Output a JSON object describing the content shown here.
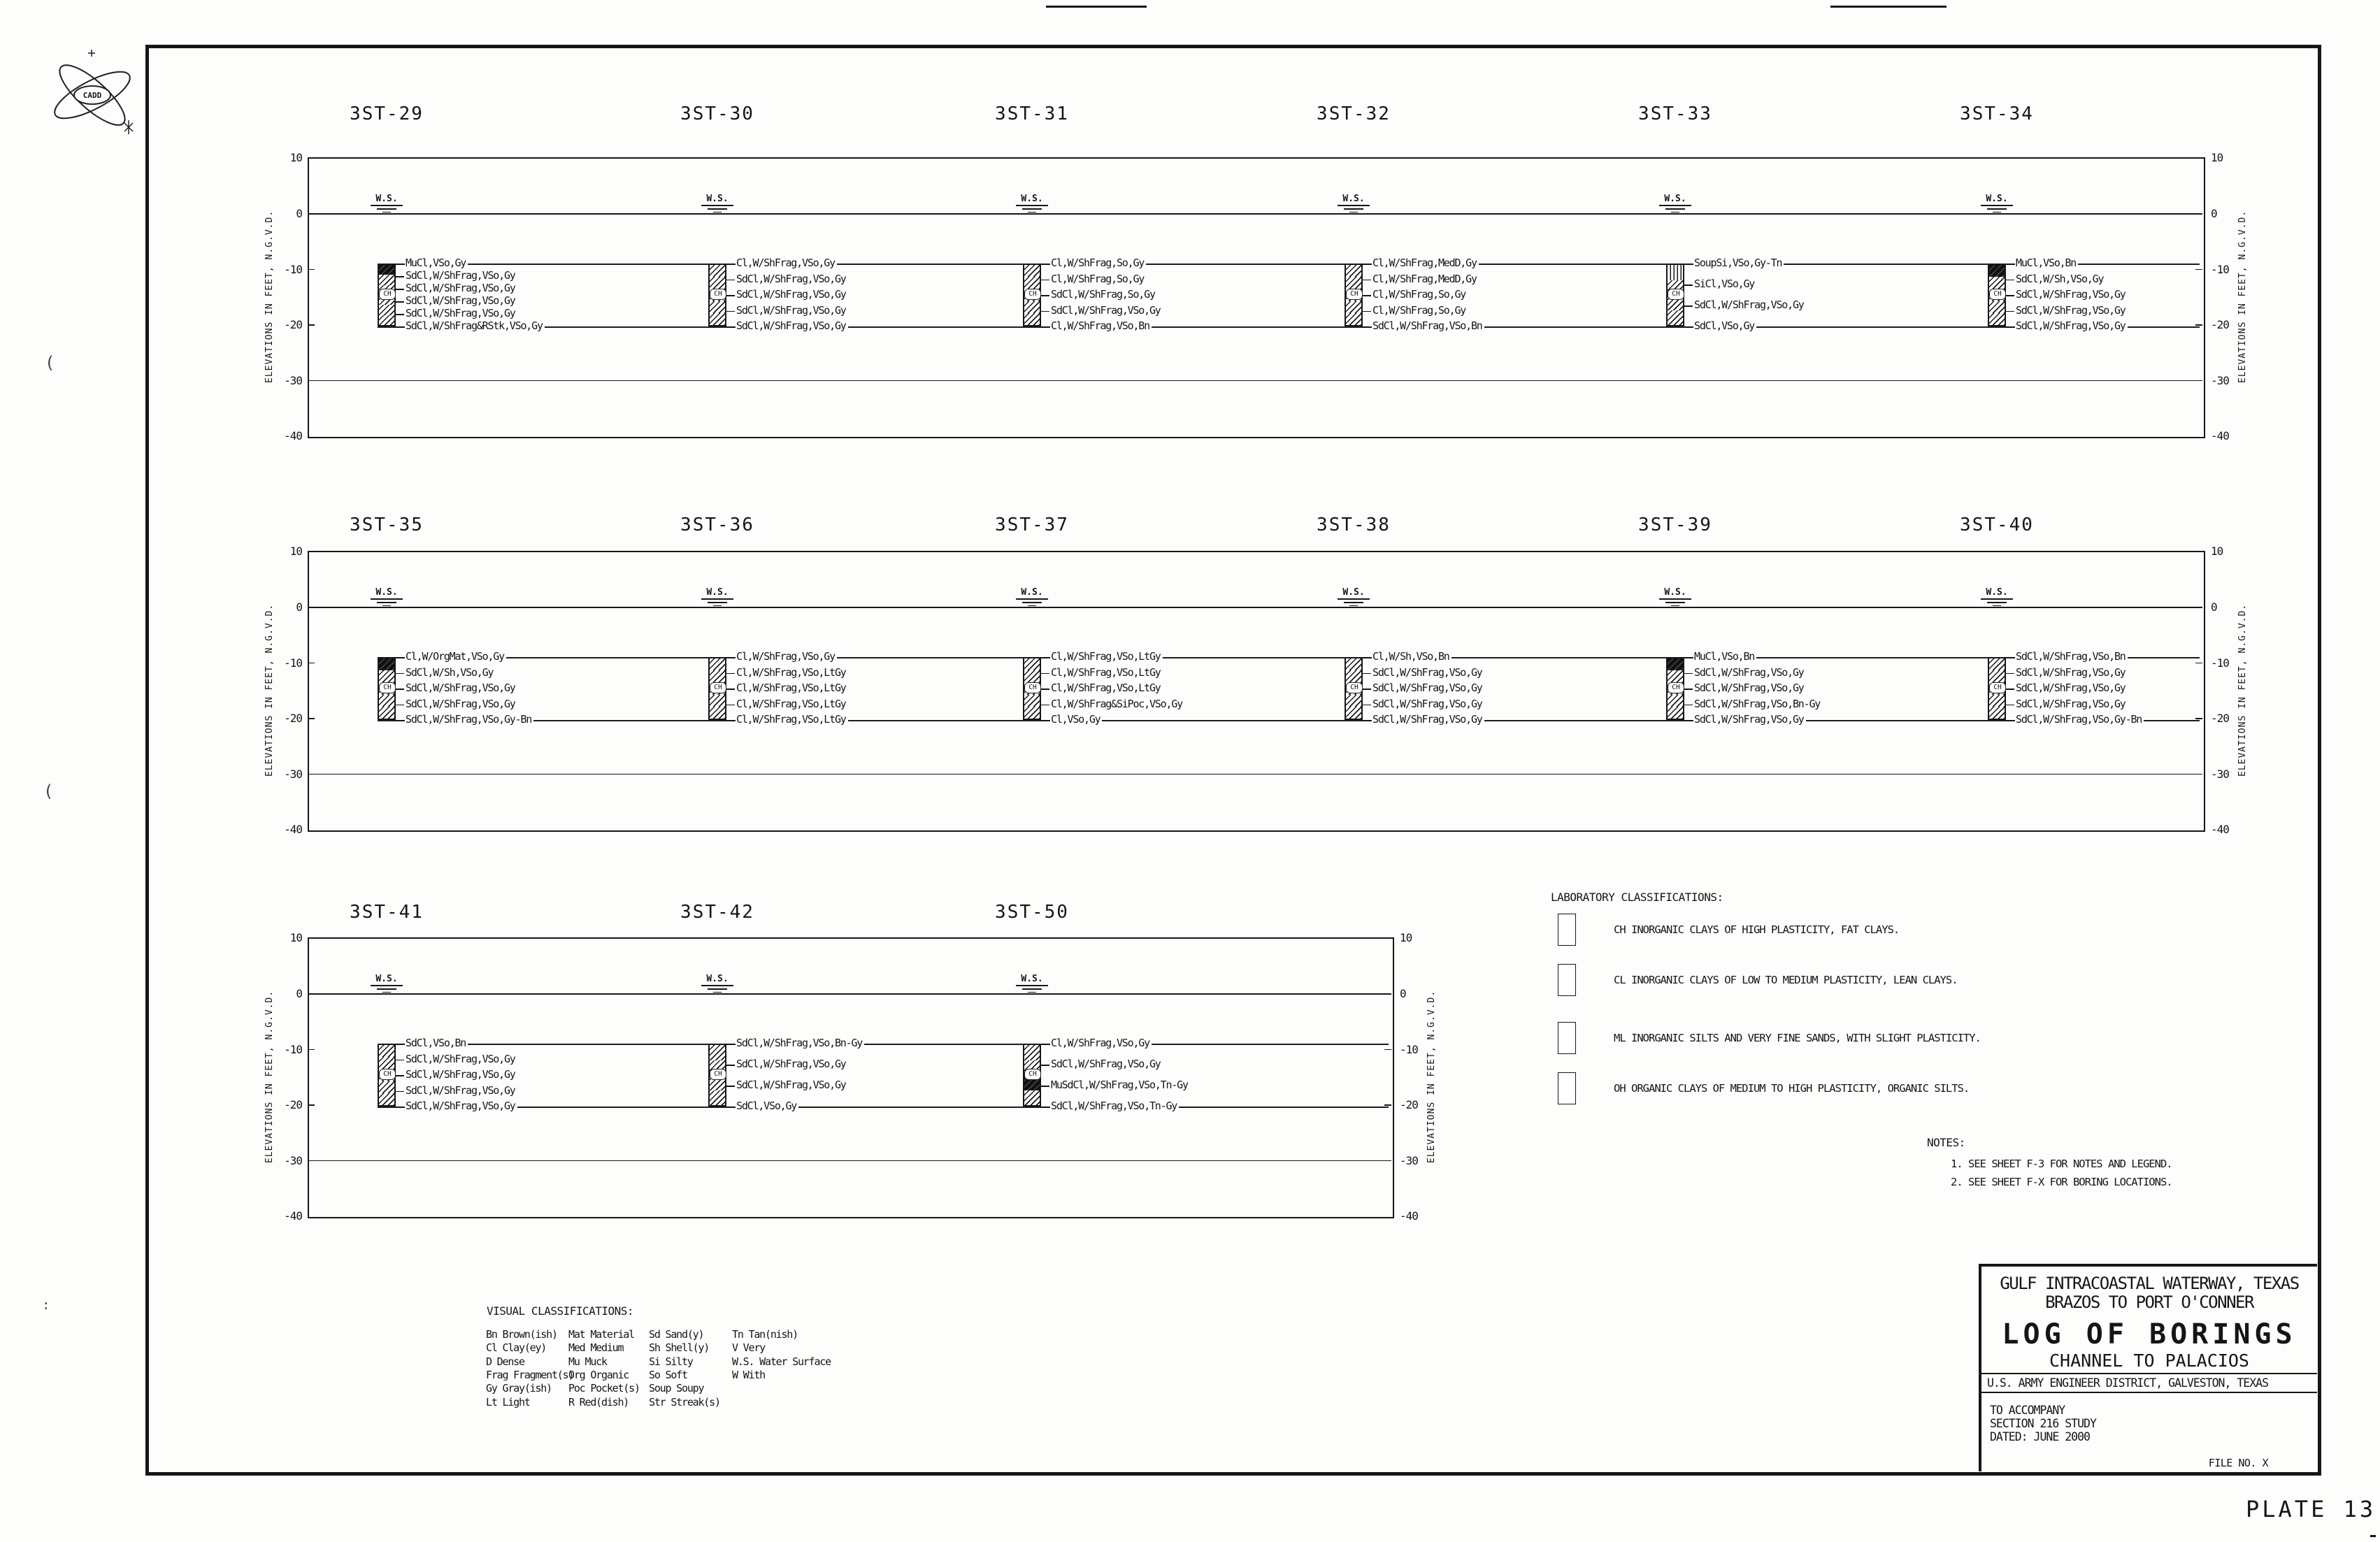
{
  "sheet": {
    "plate_label": "PLATE 13"
  },
  "cadd_logo": {
    "label": "CADD"
  },
  "axis": {
    "title": "ELEVATIONS IN FEET,  N.G.V.D.",
    "ticks": [
      "10",
      "0",
      "-10",
      "-20",
      "-30",
      "-40"
    ]
  },
  "water_surface_label": "W.S.",
  "column_class_label": "CH",
  "rows": [
    {
      "borings": [
        {
          "name": "3ST-29",
          "layers": [
            "MuCl,VSo,Gy",
            "SdCl,W/ShFrag,VSo,Gy",
            "SdCl,W/ShFrag,VSo,Gy",
            "SdCl,W/ShFrag,VSo,Gy",
            "SdCl,W/ShFrag,VSo,Gy",
            "SdCl,W/ShFrag&RStk,VSo,Gy"
          ]
        },
        {
          "name": "3ST-30",
          "layers": [
            "Cl,W/ShFrag,VSo,Gy",
            "SdCl,W/ShFrag,VSo,Gy",
            "SdCl,W/ShFrag,VSo,Gy",
            "SdCl,W/ShFrag,VSo,Gy",
            "SdCl,W/ShFrag,VSo,Gy"
          ]
        },
        {
          "name": "3ST-31",
          "layers": [
            "Cl,W/ShFrag,So,Gy",
            "Cl,W/ShFrag,So,Gy",
            "SdCl,W/ShFrag,So,Gy",
            "SdCl,W/ShFrag,VSo,Gy",
            "Cl,W/ShFrag,VSo,Bn"
          ]
        },
        {
          "name": "3ST-32",
          "layers": [
            "Cl,W/ShFrag,MedD,Gy",
            "Cl,W/ShFrag,MedD,Gy",
            "Cl,W/ShFrag,So,Gy",
            "Cl,W/ShFrag,So,Gy",
            "SdCl,W/ShFrag,VSo,Bn"
          ]
        },
        {
          "name": "3ST-33",
          "layers": [
            "SoupSi,VSo,Gy-Tn",
            "SiCl,VSo,Gy",
            "SdCl,W/ShFrag,VSo,Gy",
            "SdCl,VSo,Gy"
          ]
        },
        {
          "name": "3ST-34",
          "layers": [
            "MuCl,VSo,Bn",
            "SdCl,W/Sh,VSo,Gy",
            "SdCl,W/ShFrag,VSo,Gy",
            "SdCl,W/ShFrag,VSo,Gy",
            "SdCl,W/ShFrag,VSo,Gy"
          ]
        }
      ]
    },
    {
      "borings": [
        {
          "name": "3ST-35",
          "layers": [
            "Cl,W/OrgMat,VSo,Gy",
            "SdCl,W/Sh,VSo,Gy",
            "SdCl,W/ShFrag,VSo,Gy",
            "SdCl,W/ShFrag,VSo,Gy",
            "SdCl,W/ShFrag,VSo,Gy-Bn"
          ]
        },
        {
          "name": "3ST-36",
          "layers": [
            "Cl,W/ShFrag,VSo,Gy",
            "Cl,W/ShFrag,VSo,LtGy",
            "Cl,W/ShFrag,VSo,LtGy",
            "Cl,W/ShFrag,VSo,LtGy",
            "Cl,W/ShFrag,VSo,LtGy"
          ]
        },
        {
          "name": "3ST-37",
          "layers": [
            "Cl,W/ShFrag,VSo,LtGy",
            "Cl,W/ShFrag,VSo,LtGy",
            "Cl,W/ShFrag,VSo,LtGy",
            "Cl,W/ShFrag&SiPoc,VSo,Gy",
            "Cl,VSo,Gy"
          ]
        },
        {
          "name": "3ST-38",
          "layers": [
            "Cl,W/Sh,VSo,Bn",
            "SdCl,W/ShFrag,VSo,Gy",
            "SdCl,W/ShFrag,VSo,Gy",
            "SdCl,W/ShFrag,VSo,Gy",
            "SdCl,W/ShFrag,VSo,Gy"
          ]
        },
        {
          "name": "3ST-39",
          "layers": [
            "MuCl,VSo,Bn",
            "SdCl,W/ShFrag,VSo,Gy",
            "SdCl,W/ShFrag,VSo,Gy",
            "SdCl,W/ShFrag,VSo,Bn-Gy",
            "SdCl,W/ShFrag,VSo,Gy"
          ]
        },
        {
          "name": "3ST-40",
          "layers": [
            "SdCl,W/ShFrag,VSo,Bn",
            "SdCl,W/ShFrag,VSo,Gy",
            "SdCl,W/ShFrag,VSo,Gy",
            "SdCl,W/ShFrag,VSo,Gy",
            "SdCl,W/ShFrag,VSo,Gy-Bn"
          ]
        }
      ]
    },
    {
      "borings": [
        {
          "name": "3ST-41",
          "layers": [
            "SdCl,VSo,Bn",
            "SdCl,W/ShFrag,VSo,Gy",
            "SdCl,W/ShFrag,VSo,Gy",
            "SdCl,W/ShFrag,VSo,Gy",
            "SdCl,W/ShFrag,VSo,Gy"
          ]
        },
        {
          "name": "3ST-42",
          "layers": [
            "SdCl,W/ShFrag,VSo,Bn-Gy",
            "SdCl,W/ShFrag,VSo,Gy",
            "SdCl,W/ShFrag,VSo,Gy",
            "SdCl,VSo,Gy"
          ]
        },
        {
          "name": "3ST-50",
          "layers": [
            "Cl,W/ShFrag,VSo,Gy",
            "SdCl,W/ShFrag,VSo,Gy",
            "MuSdCl,W/ShFrag,VSo,Tn-Gy",
            "SdCl,W/ShFrag,VSo,Tn-Gy"
          ]
        }
      ]
    }
  ],
  "lab_classifications": {
    "title": "LABORATORY CLASSIFICATIONS:",
    "items": [
      {
        "pattern": "ch",
        "text": "CH INORGANIC CLAYS OF HIGH PLASTICITY, FAT CLAYS."
      },
      {
        "pattern": "cl",
        "text": "CL INORGANIC CLAYS OF LOW TO MEDIUM PLASTICITY, LEAN CLAYS."
      },
      {
        "pattern": "ml",
        "text": "ML INORGANIC SILTS AND VERY FINE SANDS, WITH SLIGHT PLASTICITY."
      },
      {
        "pattern": "oh",
        "text": "OH ORGANIC CLAYS OF MEDIUM TO HIGH PLASTICITY, ORGANIC SILTS."
      }
    ]
  },
  "notes": {
    "title": "NOTES:",
    "items": [
      "1. SEE SHEET F-3 FOR NOTES AND LEGEND.",
      "2. SEE SHEET F-X FOR BORING LOCATIONS."
    ]
  },
  "visual_classifications": {
    "title": "VISUAL CLASSIFICATIONS:",
    "columns": [
      [
        "Bn Brown(ish)",
        "Cl Clay(ey)",
        "D Dense",
        "Frag Fragment(s)",
        "Gy Gray(ish)",
        "Lt Light"
      ],
      [
        "Mat Material",
        "Med Medium",
        "Mu Muck",
        "Org Organic",
        "Poc Pocket(s)",
        "R Red(dish)"
      ],
      [
        "Sd Sand(y)",
        "Sh Shell(y)",
        "Si Silty",
        "So Soft",
        "Soup Soupy",
        "Str Streak(s)"
      ],
      [
        "Tn Tan(nish)",
        "V Very",
        "W.S. Water Surface",
        "W With"
      ]
    ]
  },
  "title_block": {
    "line1": "GULF INTRACOASTAL WATERWAY, TEXAS",
    "line2": "BRAZOS TO PORT O'CONNER",
    "main_title": "LOG OF BORINGS",
    "subtitle": "CHANNEL TO PALACIOS",
    "district": "U.S. ARMY ENGINEER DISTRICT, GALVESTON, TEXAS",
    "accompany": [
      "TO ACCOMPANY",
      "SECTION 216 STUDY",
      "DATED: JUNE 2000"
    ],
    "file_no": "FILE NO. X"
  }
}
